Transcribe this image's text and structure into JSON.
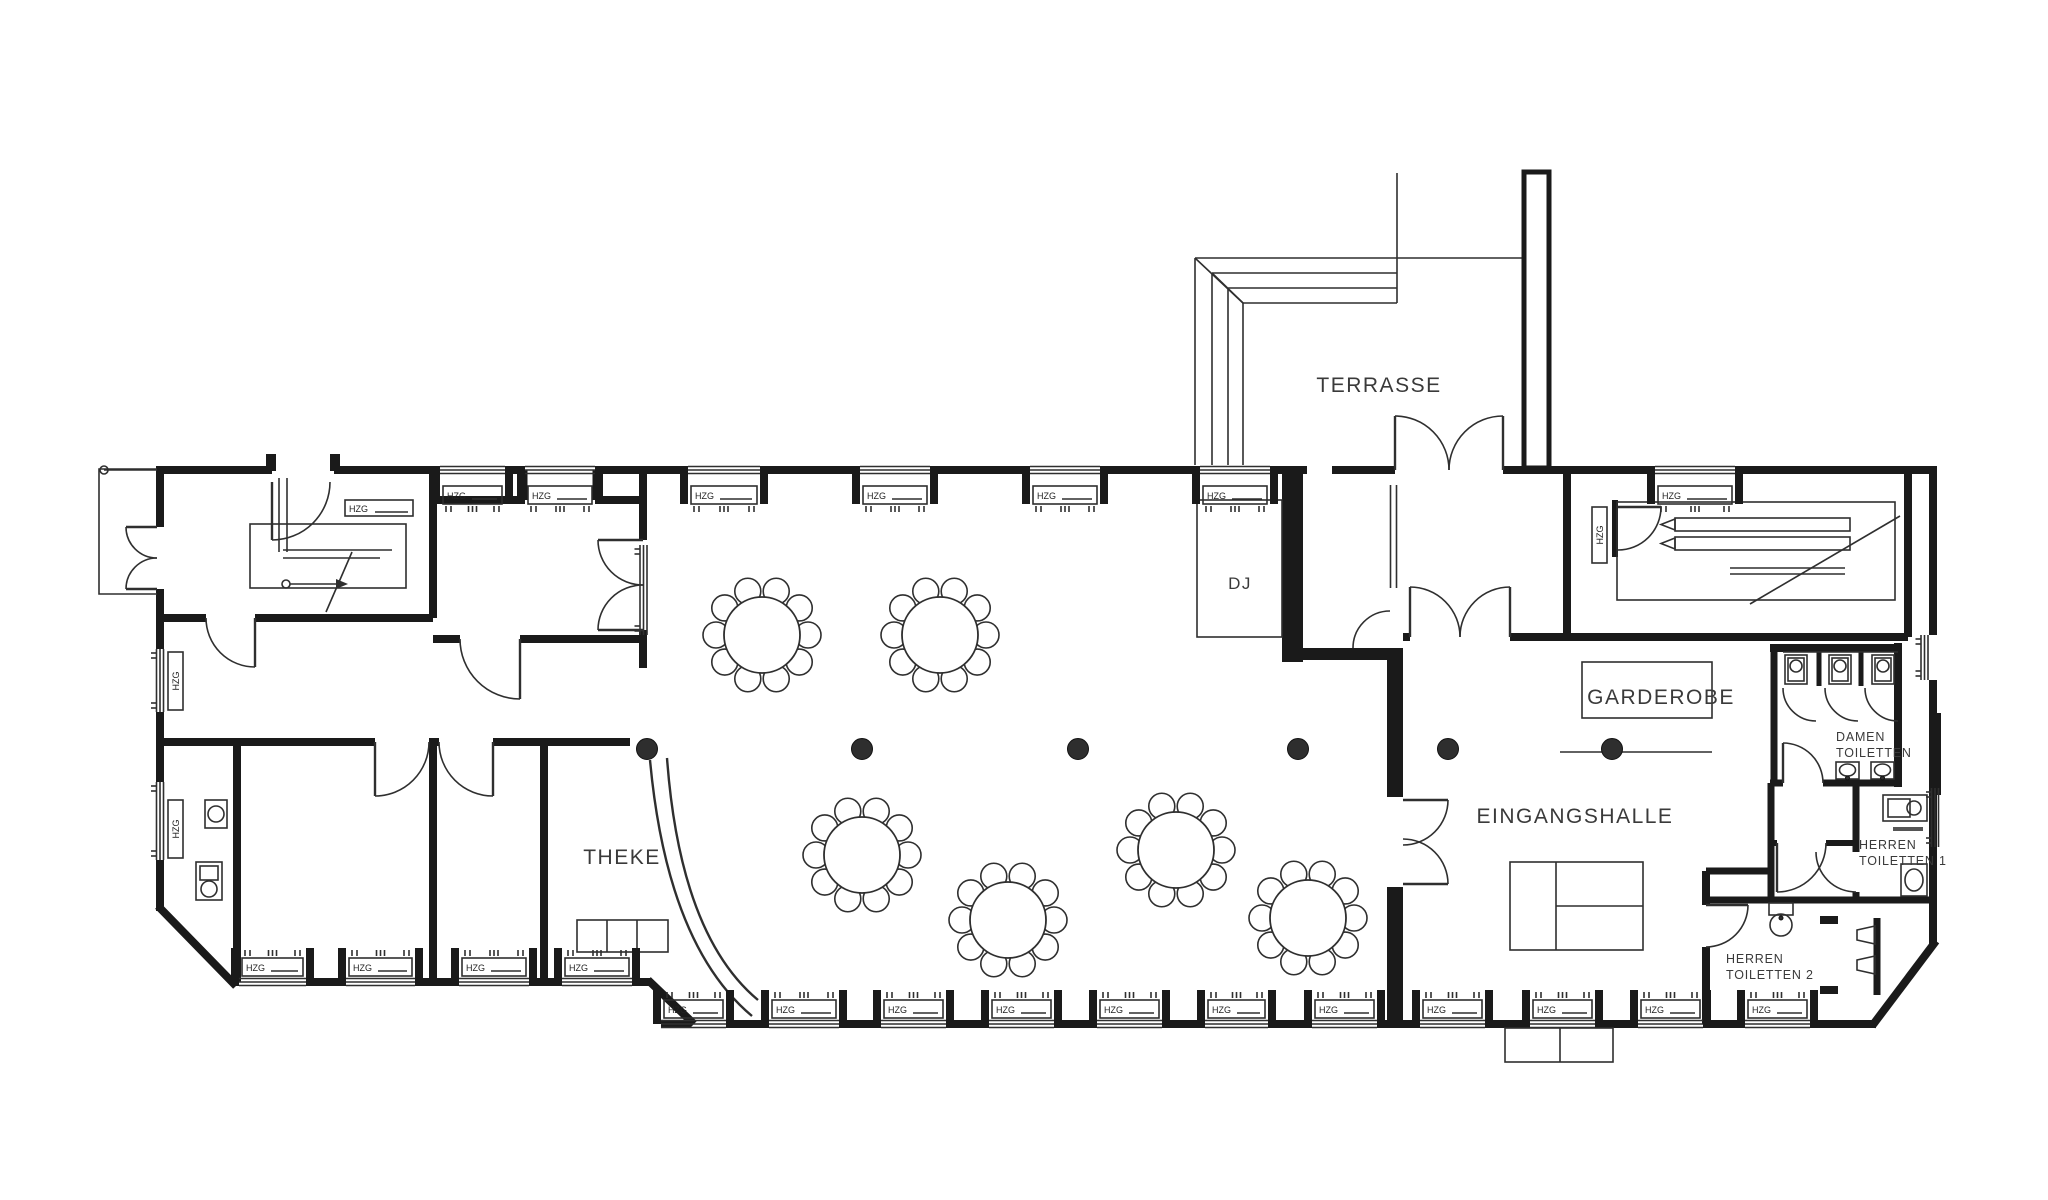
{
  "palette": {
    "background": "#ffffff",
    "wall": "#1a1a1a",
    "line": "#2f2f2f",
    "text": "#3a3a3a"
  },
  "labels": {
    "terrasse": "TERRASSE",
    "dj": "DJ",
    "garderobe": "GARDEROBE",
    "eingangshalle": "EINGANGSHALLE",
    "theke": "THEKE",
    "damen_line1": "DAMEN",
    "damen_line2": "TOILETTEN",
    "herren1_line1": "HERREN",
    "herren1_line2": "TOILETTEN 1",
    "herren2_line1": "HERREN",
    "herren2_line2": "TOILETTEN 2",
    "radiator": "HZG"
  },
  "fixtures": {
    "round_table_count": 6,
    "seats_per_table": 10,
    "column_count": 6,
    "damen_toilet_stalls": 3,
    "damen_sinks": 2,
    "herren2_urinals": 2
  }
}
